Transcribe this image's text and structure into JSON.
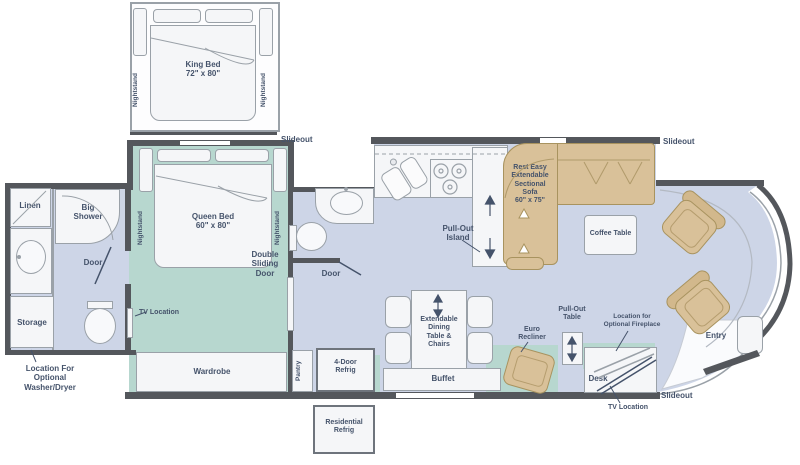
{
  "diagram_type": "rv-motorhome-floorplan",
  "colors": {
    "wall": "#54575c",
    "floor_main": "#cdd5e7",
    "floor_bedroom": "#b7d7cf",
    "furniture_white": "#f5f6f8",
    "furniture_tan": "#d9c199",
    "outline_gray": "#9aa1a8",
    "label_text": "#45536b"
  },
  "labels": {
    "king_bed": "King Bed\n72\" x 80\"",
    "queen_bed": "Queen Bed\n60\" x 80\"",
    "nightstand": "Nightstand",
    "slideout": "Slideout",
    "linen": "Linen",
    "big_shower": "Big\nShower",
    "door": "Door",
    "storage": "Storage",
    "washer_dryer": "Location For\nOptional\nWasher/Dryer",
    "tv_location": "TV Location",
    "double_sliding_door": "Double\nSliding\nDoor",
    "wardrobe": "Wardrobe",
    "pantry": "Pantry",
    "four_door_refrig": "4-Door\nRefrig",
    "residential_refrig": "Residential\nRefrig",
    "pull_out_island": "Pull-Out\nIsland",
    "sectional_sofa": "Rest Easy\nExtendable\nSectional\nSofa\n60\" x 75\"",
    "coffee_table": "Coffee Table",
    "dining": "Extendable\nDining\nTable &\nChairs",
    "buffet": "Buffet",
    "euro_recliner": "Euro\nRecliner",
    "pull_out_table": "Pull-Out\nTable",
    "fireplace": "Location for\nOptional Fireplace",
    "desk": "Desk",
    "entry": "Entry"
  }
}
